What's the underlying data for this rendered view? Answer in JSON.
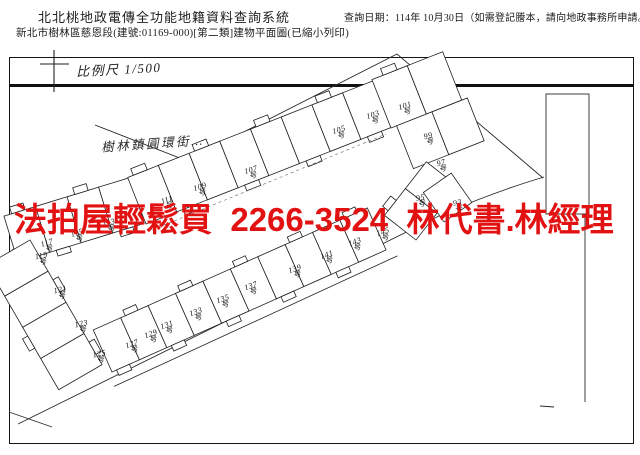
{
  "header": {
    "system_title": "北北桃地政電傳全功能地籍資料查詢系統",
    "document_title": "新北市樹林區慈恩段(建號:01169-000)[第二類]建物平面圖(已縮小列印)",
    "query_date": "查詢日期：114年 10月30日（如需登記謄本，請向地政事務所申請。）"
  },
  "map": {
    "scale_label": "比例尺 1/500",
    "street_label": "樹林鎮圓環街…",
    "unit_suffix": "号",
    "units": [
      {
        "no": "117",
        "x": 48,
        "y": 246,
        "r": -18
      },
      {
        "no": "115",
        "x": 78,
        "y": 236,
        "r": -18
      },
      {
        "no": "113",
        "x": 110,
        "y": 226,
        "r": -18
      },
      {
        "no": "111",
        "x": 168,
        "y": 203,
        "r": -18
      },
      {
        "no": "109",
        "x": 201,
        "y": 190,
        "r": -18
      },
      {
        "no": "107",
        "x": 252,
        "y": 173,
        "r": -18
      },
      {
        "no": "105",
        "x": 340,
        "y": 133,
        "r": -18
      },
      {
        "no": "103",
        "x": 374,
        "y": 118,
        "r": -18
      },
      {
        "no": "101",
        "x": 406,
        "y": 109,
        "r": -18
      },
      {
        "no": "99",
        "x": 429,
        "y": 139,
        "r": -15
      },
      {
        "no": "97",
        "x": 442,
        "y": 166,
        "r": -15
      },
      {
        "no": "95",
        "x": 421,
        "y": 201,
        "r": -10
      },
      {
        "no": "93",
        "x": 458,
        "y": 206,
        "r": -10
      },
      {
        "no": "119",
        "x": 42,
        "y": 259,
        "r": -12
      },
      {
        "no": "121",
        "x": 61,
        "y": 293,
        "r": -12
      },
      {
        "no": "123",
        "x": 82,
        "y": 327,
        "r": -12
      },
      {
        "no": "125",
        "x": 100,
        "y": 357,
        "r": -12
      },
      {
        "no": "127",
        "x": 133,
        "y": 347,
        "r": -20
      },
      {
        "no": "129",
        "x": 152,
        "y": 337,
        "r": -20
      },
      {
        "no": "131",
        "x": 168,
        "y": 328,
        "r": -20
      },
      {
        "no": "133",
        "x": 197,
        "y": 315,
        "r": -20
      },
      {
        "no": "135",
        "x": 224,
        "y": 302,
        "r": -20
      },
      {
        "no": "137",
        "x": 252,
        "y": 289,
        "r": -20
      },
      {
        "no": "139",
        "x": 296,
        "y": 272,
        "r": -20
      },
      {
        "no": "141",
        "x": 328,
        "y": 258,
        "r": -20
      },
      {
        "no": "143",
        "x": 356,
        "y": 245,
        "r": -20
      },
      {
        "no": "145",
        "x": 384,
        "y": 235,
        "r": -20
      }
    ]
  },
  "watermark": {
    "text": "法拍屋輕鬆買  2266-3524  林代書.林經理",
    "color": "#e31212"
  }
}
